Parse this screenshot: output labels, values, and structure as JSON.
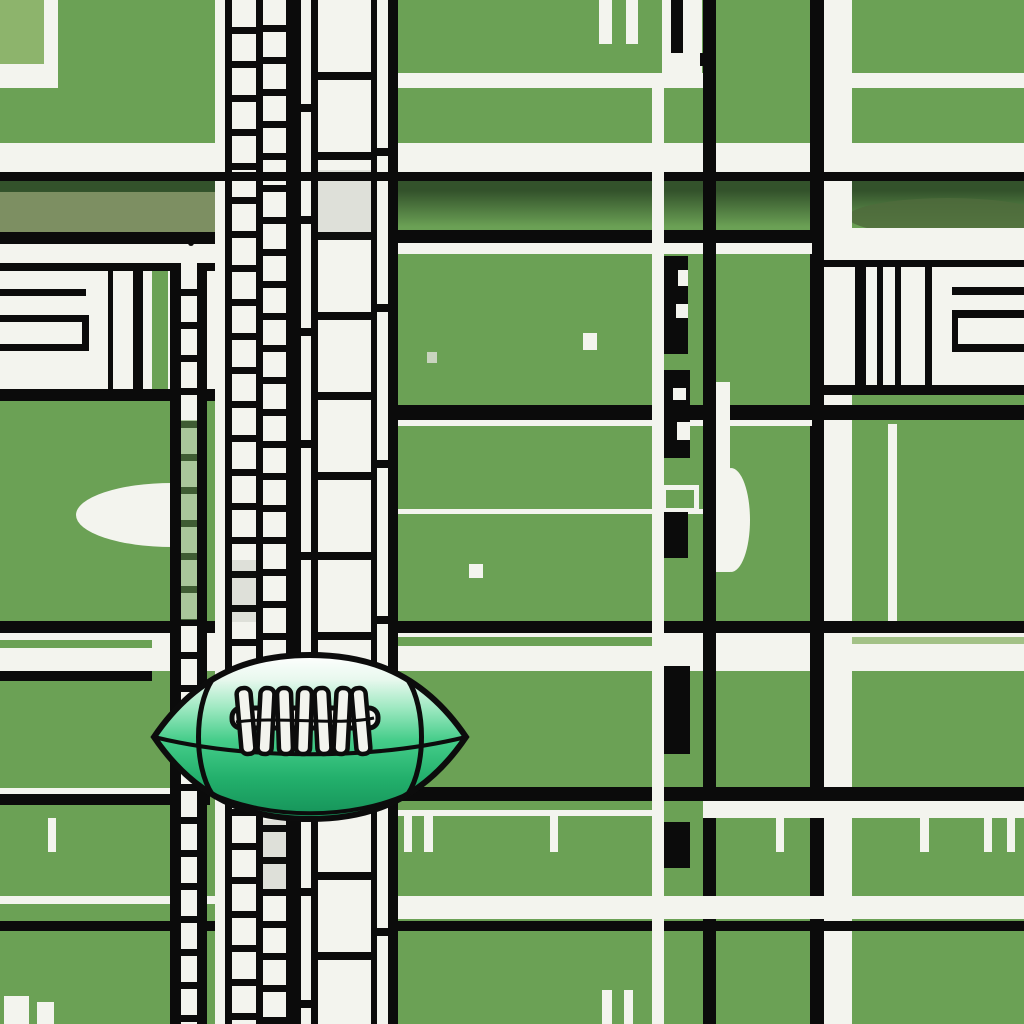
{
  "meta": {
    "type": "abstract illustration",
    "subject": "Cartoon green-and-white American football resting on a Mondrian-style grid of green fields, black grid lines, white bands and film-strip ladder columns",
    "visible_text": "none"
  },
  "palette": {
    "field": "#6ba155",
    "field_light": "#8db46c",
    "paper": "#f3f4ee",
    "line": "#0b0b0b",
    "shade": "#33522b",
    "shade2": "#4f6b3c",
    "olive": "#7d8f62",
    "tint": "#c9d4bf",
    "ball_top": "#ffffff",
    "ball_mint": "#9fe9c2",
    "ball_green": "#2fbc78",
    "ball_deep": "#159158"
  },
  "football": {
    "title": "Green and white cartoon football with black seams and laces",
    "lace_teeth_count": 7,
    "orientation": "horizontal, pointed tips left and right"
  },
  "grid": {
    "ladder_title": "Vertical film-strip ladder column",
    "mini_ladder_title": "Narrow ladder column",
    "dash_title": "Black dash markers along vertical street",
    "panel_left_title": "Striped panel left",
    "panel_right_title": "Striped panel right"
  }
}
